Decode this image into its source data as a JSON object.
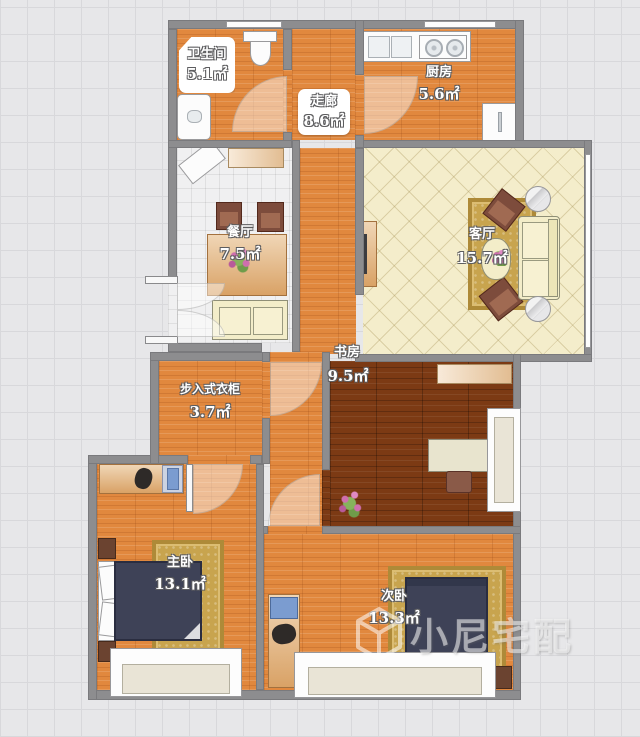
{
  "plan": {
    "watermark": "小尼宅配",
    "rooms": {
      "bathroom": {
        "name": "卫生间",
        "area": "5.1㎡"
      },
      "kitchen": {
        "name": "厨房",
        "area": "5.6㎡"
      },
      "corridor": {
        "name": "走廊",
        "area": "8.6㎡"
      },
      "dining": {
        "name": "餐厅",
        "area": "7.5㎡"
      },
      "living": {
        "name": "客厅",
        "area": "15.7㎡"
      },
      "study": {
        "name": "书房",
        "area": "9.5㎡"
      },
      "closet": {
        "name": "步入式衣柜",
        "area": "3.7㎡"
      },
      "master": {
        "name": "主卧",
        "area": "13.1㎡"
      },
      "secondary": {
        "name": "次卧",
        "area": "13.3㎡"
      }
    },
    "furniture": {
      "bathroom": [
        "toilet",
        "washbasin"
      ],
      "kitchen": [
        "sink",
        "stove",
        "fridge"
      ],
      "dining": [
        "shoe-cabinet",
        "sideboard",
        "dining-chair",
        "dining-chair",
        "dining-table",
        "flowers",
        "bench-sofa"
      ],
      "living": [
        "tv-stand",
        "tv",
        "armchair",
        "armchair",
        "sofa",
        "coffee-table",
        "side-table",
        "side-table",
        "rug"
      ],
      "study": [
        "cabinet",
        "desk",
        "office-chair",
        "bay-window",
        "plant"
      ],
      "master": [
        "dressing-desk",
        "chair",
        "wardrobe",
        "bed",
        "pillows",
        "nightstand",
        "nightstand",
        "rug",
        "bay-window"
      ],
      "secondary": [
        "computer-desk",
        "office-chair",
        "bed",
        "nightstand",
        "rug",
        "bay-window"
      ]
    },
    "colors": {
      "wall": "#8d8d8f",
      "floor_wood": "#e1883e",
      "floor_wood_dark": "#7c3a14",
      "living_tile": "#f4edcb",
      "dining_tile": "#f0f0f1",
      "rug": "#c8a44e",
      "bed": "#3e4257",
      "background": "#e7e7e9"
    }
  }
}
